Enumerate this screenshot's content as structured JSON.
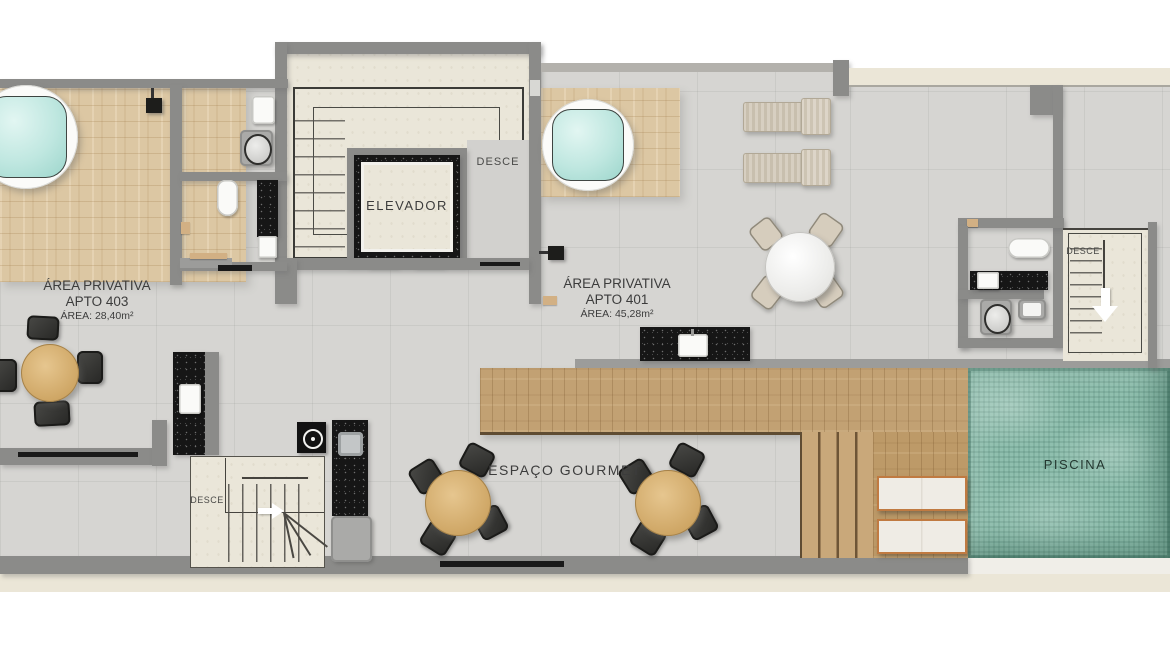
{
  "plan": {
    "units": [
      {
        "line1": "ÁREA PRIVATIVA",
        "line2": "APTO 403",
        "line3": "ÁREA: 28,40m²"
      },
      {
        "line1": "ÁREA PRIVATIVA",
        "line2": "APTO 401",
        "line3": "ÁREA: 45,28m²"
      }
    ],
    "elevator": {
      "label": "ELEVADOR"
    },
    "stairs": {
      "elevator_landing_label": "DESCE",
      "right_label": "DESCE",
      "bottom_left_label": "DESCE"
    },
    "gourmet_label": "ESPAÇO GOURMET",
    "pool_label": "PISCINA"
  },
  "icons": {
    "stairs_down_arrow": "triangle-down-white",
    "stairs_right_arrow": "triangle-right-white"
  },
  "colors": {
    "background": "#ffffff",
    "floor": "#d6d5d2",
    "wall": "#8b8b89",
    "cream_floor": "#eae6d9",
    "cream_band": "#ebe6d7",
    "wood_light": "#dcc7a3",
    "wood_warm": "#c2a173",
    "granite": "#161616",
    "pool_water": "#8fbfae",
    "jacuzzi_water": "#bfe7e0",
    "label_text": "#3c3c3c"
  }
}
